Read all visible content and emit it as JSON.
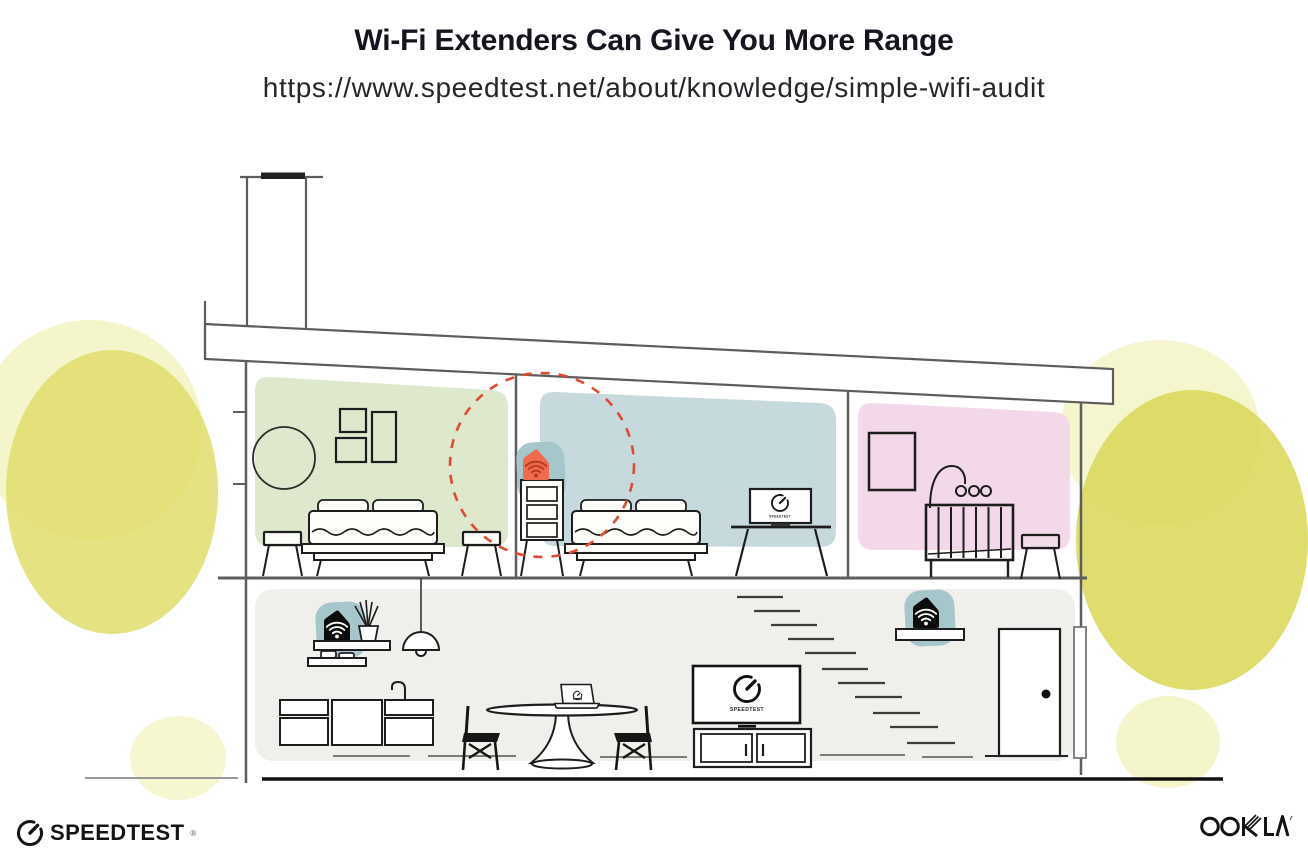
{
  "header": {
    "title": "Wi-Fi Extenders Can Give You More Range",
    "url": "https://www.speedtest.net/about/knowledge/simple-wifi-audit"
  },
  "illustration": {
    "description": "Cross-section of a house showing a Wi-Fi router downstairs and Wi-Fi extenders extending coverage upstairs",
    "rooms": {
      "bedroom_left": {
        "name": "left bedroom",
        "accent_color": "#dee8cc"
      },
      "bedroom_middle": {
        "name": "middle bedroom",
        "accent_color": "#c6d9dd"
      },
      "nursery": {
        "name": "nursery",
        "accent_color": "#f3d8e9"
      },
      "living_area": {
        "name": "downstairs living area",
        "accent_color": "#f1efec"
      }
    },
    "devices": {
      "extender_upstairs": {
        "kind": "wifi-extender",
        "body_color": "#f06a4d",
        "icon_color": "#b5391f",
        "halo_color": "#a5c6cb",
        "range_ring_color": "#e04a31"
      },
      "router_downstairs": {
        "kind": "wifi-router",
        "body_color": "#0b0b0b",
        "icon_color": "#ffffff",
        "halo_color": "#a5c6cb"
      },
      "extender_downstairs": {
        "kind": "wifi-extender",
        "body_color": "#0b0b0b",
        "icon_color": "#ffffff",
        "halo_color": "#a5c6cb"
      }
    },
    "screens": {
      "bedroom_tv_label": "SPEEDTEST",
      "living_tv_label": "SPEEDTEST"
    },
    "foliage_color": "#e0dd6b",
    "line_colors": {
      "walls": "#5d5d5d",
      "furniture": "#1d1d1d",
      "ground": "#111111"
    }
  },
  "footer": {
    "speedtest_wordmark": "SPEEDTEST",
    "speedtest_reg": "®",
    "ookla_wordmark": "OOKLA"
  }
}
